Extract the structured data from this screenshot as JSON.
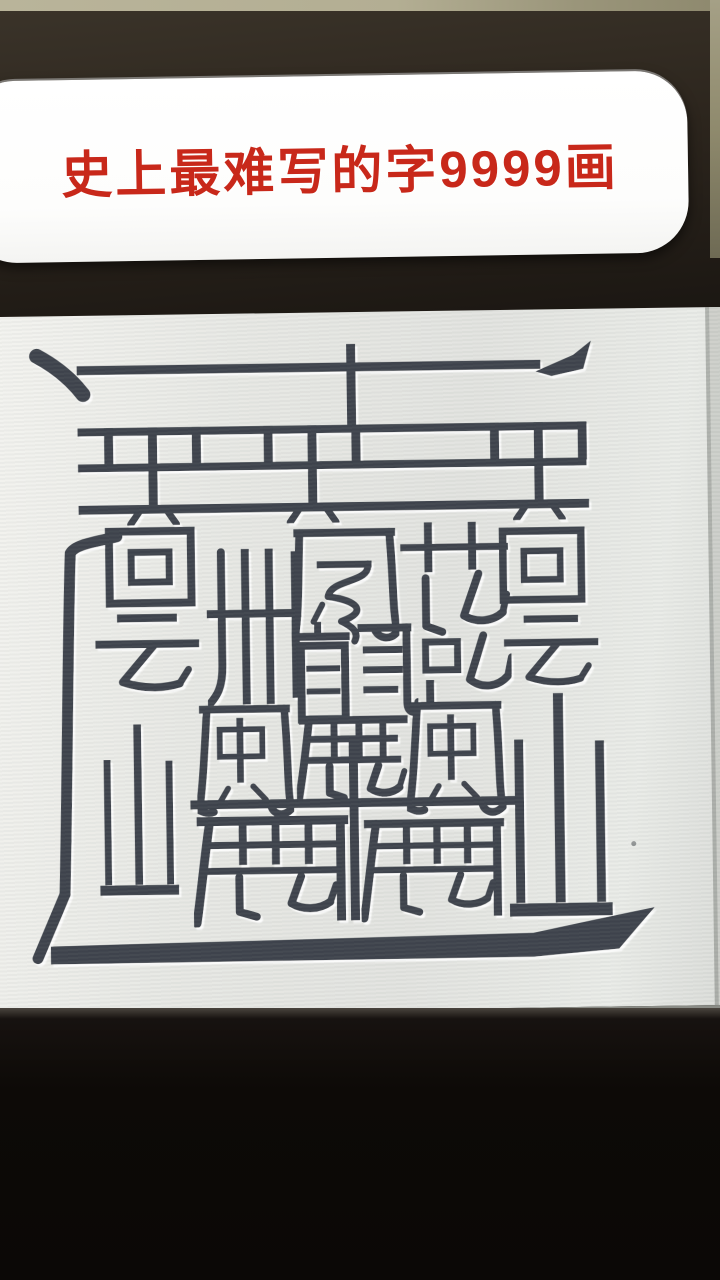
{
  "caption": {
    "text": "史上最难写的字9999画",
    "color": "#c8281a"
  },
  "character": {
    "name": "legendary-9999-stroke-character",
    "components": [
      {
        "glyph": "雷",
        "symbol": "lei",
        "x": 105,
        "y": 113,
        "w": 100,
        "h": 98
      },
      {
        "glyph": "雷",
        "symbol": "lei",
        "x": 265,
        "y": 113,
        "w": 100,
        "h": 98
      },
      {
        "glyph": "雷",
        "symbol": "lei",
        "x": 492,
        "y": 113,
        "w": 100,
        "h": 98
      },
      {
        "glyph": "回",
        "symbol": "hui",
        "x": 105,
        "y": 212,
        "w": 92,
        "h": 82
      },
      {
        "glyph": "卌",
        "symbol": "si",
        "x": 207,
        "y": 235,
        "w": 95,
        "h": 158
      },
      {
        "glyph": "鳳",
        "symbol": "fengniao",
        "x": 292,
        "y": 215,
        "w": 108,
        "h": 122
      },
      {
        "glyph": "兓",
        "symbol": "kun",
        "x": 400,
        "y": 210,
        "w": 112,
        "h": 190
      },
      {
        "glyph": "回",
        "symbol": "hui",
        "x": 500,
        "y": 213,
        "w": 88,
        "h": 87
      },
      {
        "glyph": "云",
        "symbol": "yun",
        "x": 92,
        "y": 295,
        "w": 110,
        "h": 92
      },
      {
        "glyph": "云",
        "symbol": "yun",
        "x": 502,
        "y": 298,
        "w": 100,
        "h": 92
      },
      {
        "glyph": "龍",
        "symbol": "long",
        "x": 288,
        "y": 310,
        "w": 130,
        "h": 102
      },
      {
        "glyph": "鹿",
        "symbol": "lusmall",
        "x": 295,
        "y": 403,
        "w": 115,
        "h": 88
      },
      {
        "glyph": "風",
        "symbol": "feng",
        "x": 195,
        "y": 390,
        "w": 97,
        "h": 118
      },
      {
        "glyph": "風",
        "symbol": "feng",
        "x": 405,
        "y": 390,
        "w": 100,
        "h": 118
      },
      {
        "glyph": "山",
        "symbol": "shan",
        "x": 95,
        "y": 385,
        "w": 82,
        "h": 228
      },
      {
        "glyph": "山",
        "symbol": "shan",
        "x": 505,
        "y": 383,
        "w": 107,
        "h": 235
      },
      {
        "glyph": "鹿",
        "symbol": "lu",
        "x": 190,
        "y": 503,
        "w": 160,
        "h": 112
      },
      {
        "glyph": "鹿",
        "symbol": "lu",
        "x": 358,
        "y": 505,
        "w": 148,
        "h": 110
      },
      {
        "glyph": "辶",
        "symbol": "chuo",
        "x": 0,
        "y": 0,
        "w": 720,
        "h": 700
      }
    ]
  },
  "theme": {
    "ink": "#3a4048",
    "accent_red": "#c8281a",
    "table_beige": "#b3ae93",
    "bezel_brown": "#2c251d",
    "screen_gray": "#e7e8e4"
  }
}
